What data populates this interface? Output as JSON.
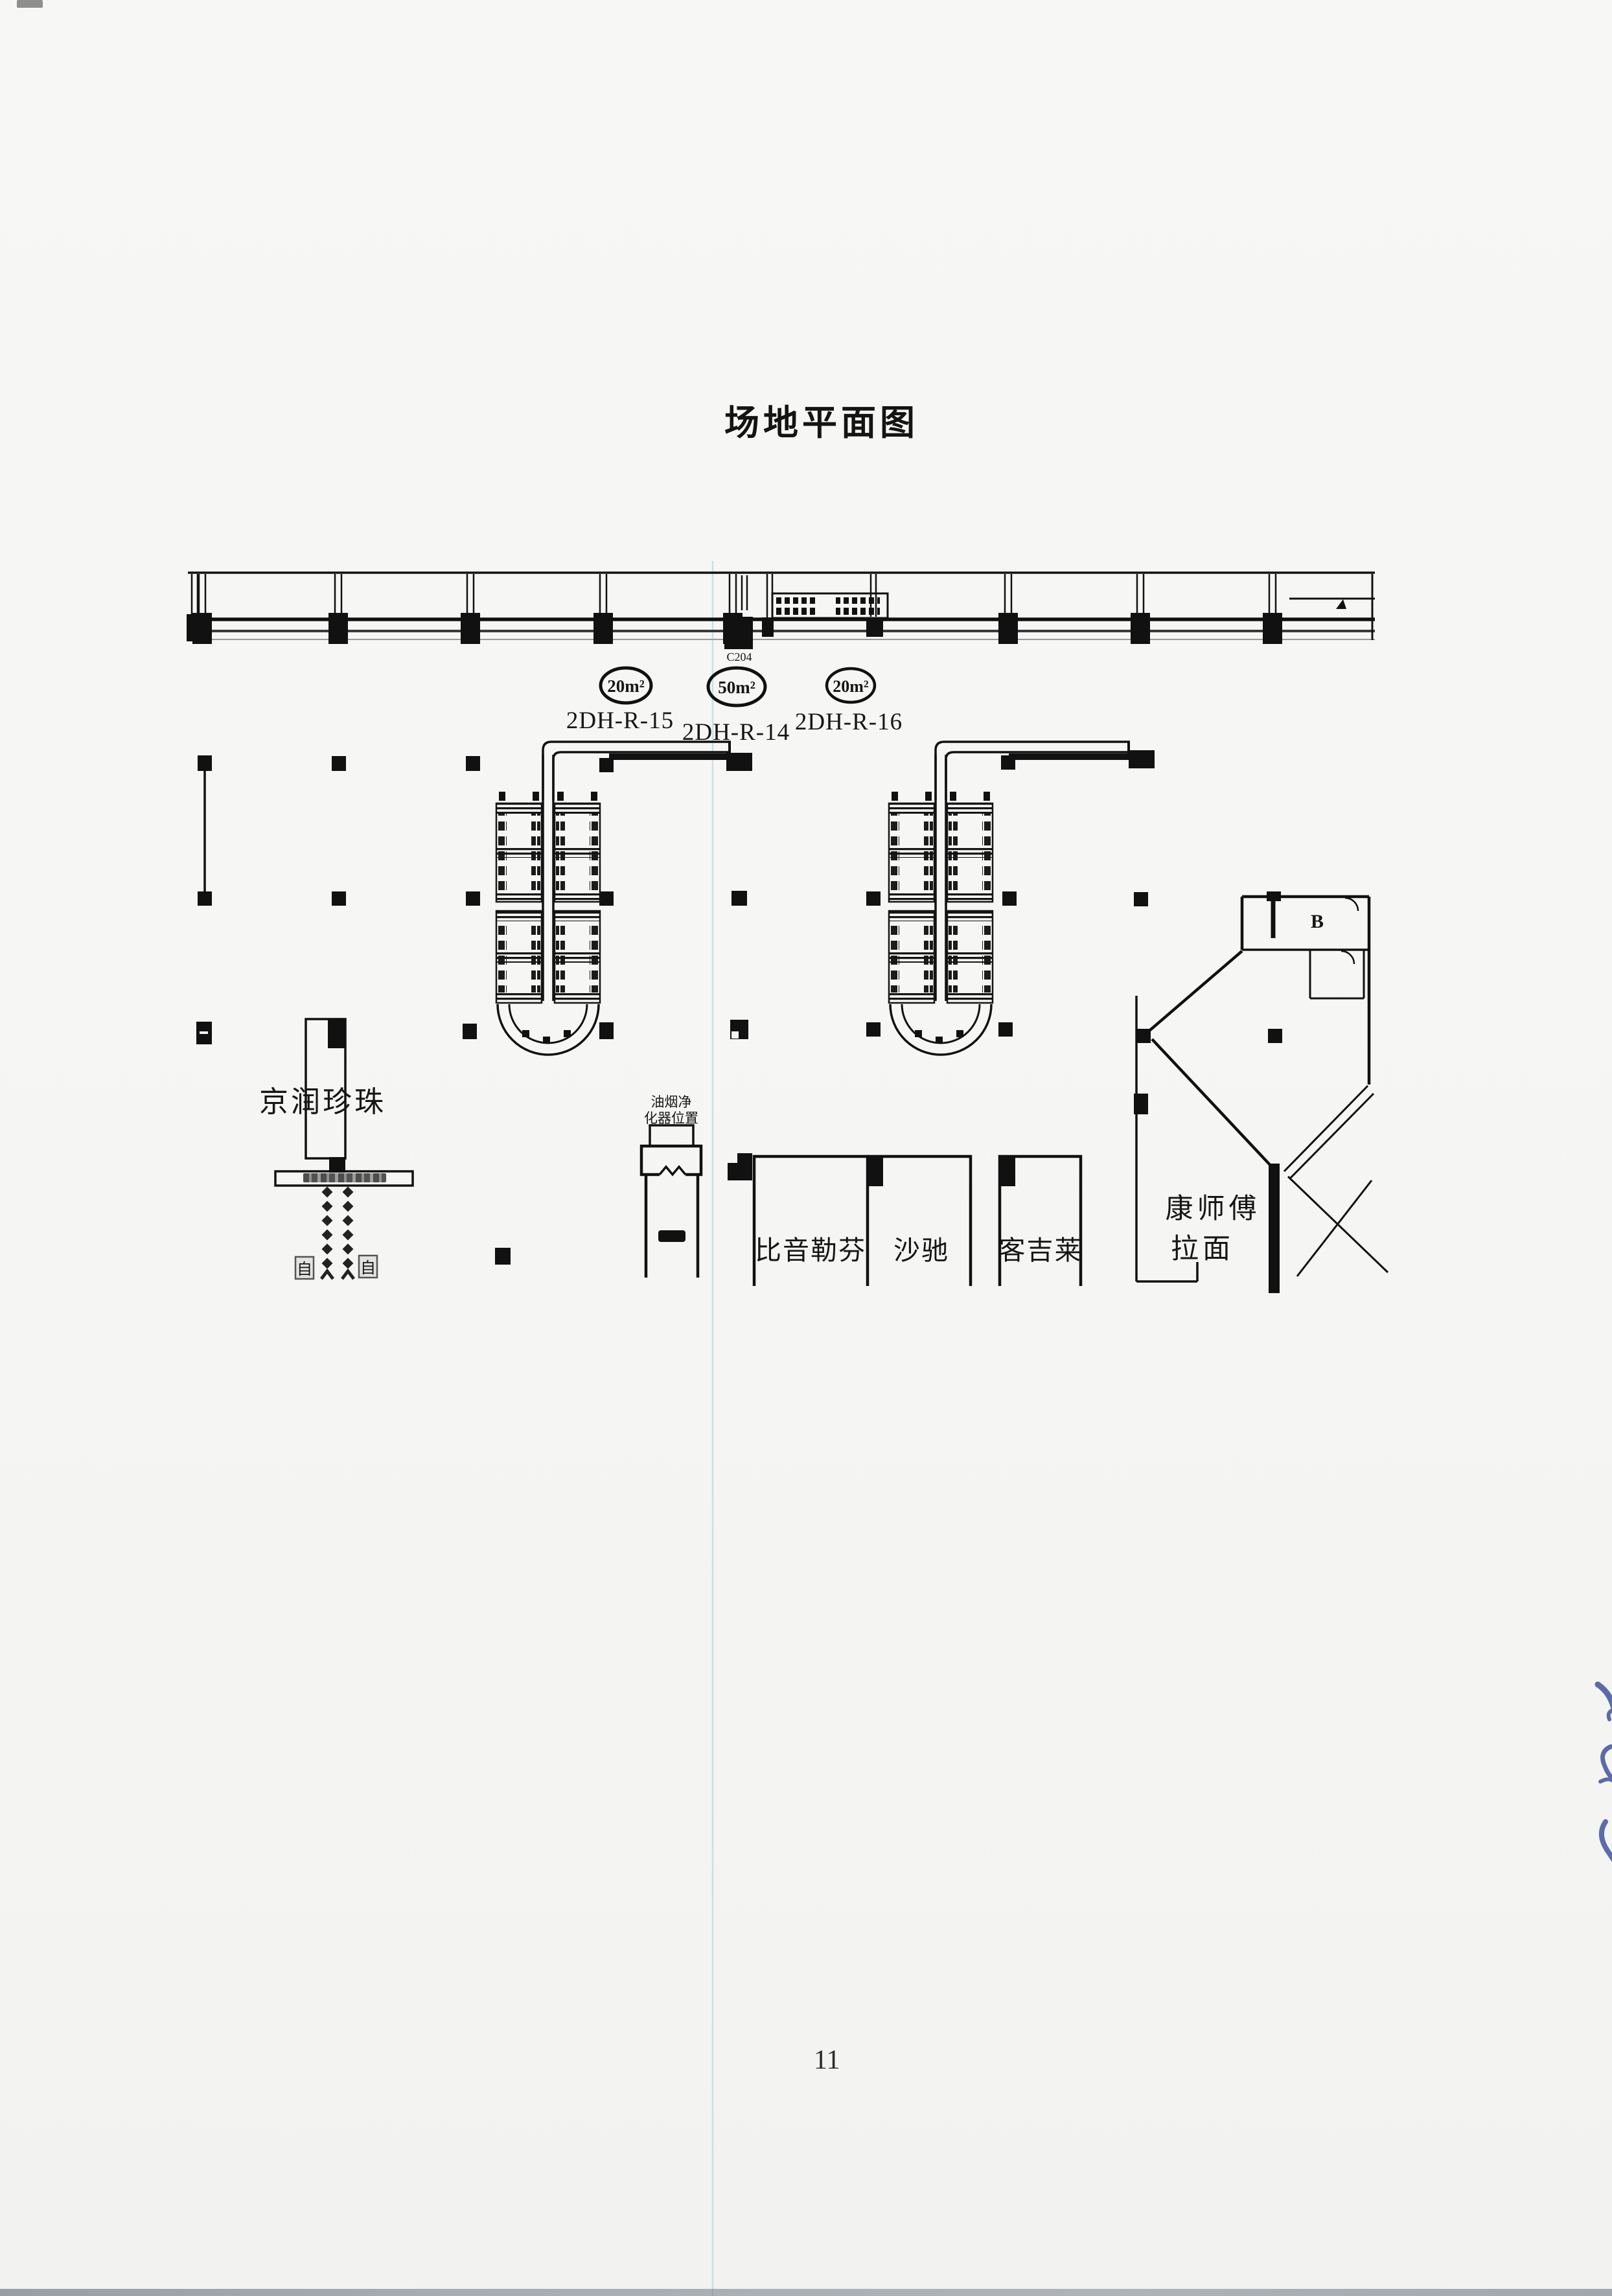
{
  "page": {
    "title": "场地平面图",
    "page_number": "11"
  },
  "plan": {
    "door_label": "C204",
    "room_label": "B",
    "units": [
      {
        "id": "2DH-R-15",
        "area": "20m²"
      },
      {
        "id": "2DH-R-14",
        "area": "50m²"
      },
      {
        "id": "2DH-R-16",
        "area": "20m²"
      }
    ],
    "stores": {
      "pearl": "京润珍珠",
      "biemlofen": "比音勒芬",
      "satchi": "沙驰",
      "kejilai": "客吉莱",
      "master_kong_line1": "康师傅",
      "master_kong_line2": "拉面"
    },
    "note": {
      "line1": "油烟净",
      "line2": "化器位置"
    },
    "escalator_glyph": "自"
  }
}
